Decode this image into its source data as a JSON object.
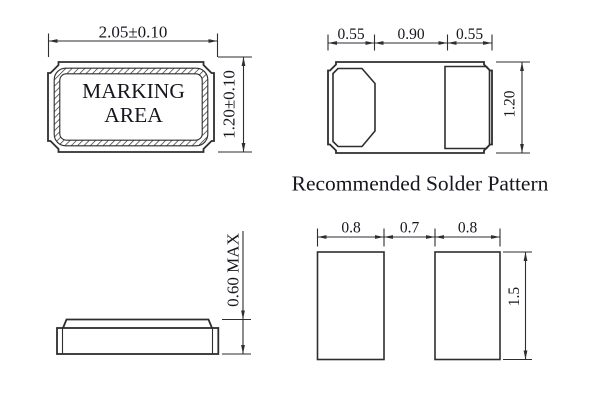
{
  "colors": {
    "background": "#ffffff",
    "line": "#2e2e2e",
    "text": "#16161f"
  },
  "views": {
    "package_top": {
      "marking_line1": "MARKING",
      "marking_line2": "AREA",
      "width_dim": "2.05±0.10",
      "height_dim": "1.20±0.10"
    },
    "solder_pattern": {
      "title": "Recommended Solder Pattern",
      "dim_left": "0.55",
      "dim_center": "0.90",
      "dim_right": "0.55",
      "dim_height": "1.20"
    },
    "package_side": {
      "height_dim": "0.60 MAX"
    },
    "pad_layout": {
      "dim_left_pad": "0.8",
      "dim_gap": "0.7",
      "dim_right_pad": "0.8",
      "dim_height": "1.5"
    }
  }
}
